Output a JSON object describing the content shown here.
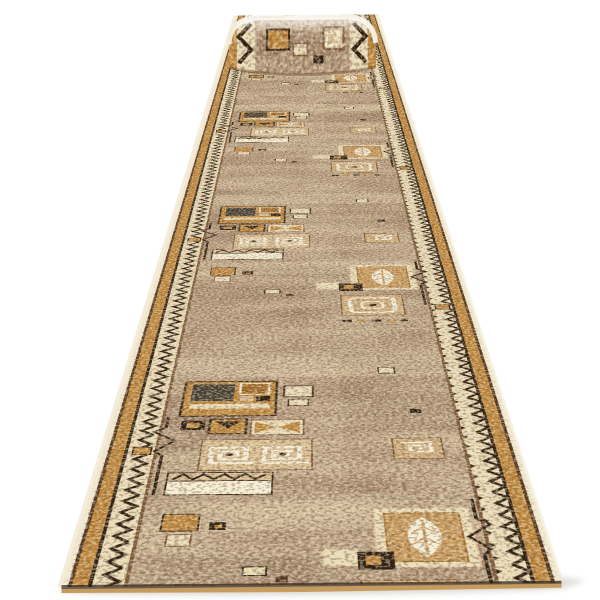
{
  "meta": {
    "alt": "Beige and brown runner carpet with geometric patchwork pattern, far end rolled over, photographed in perspective on a white background"
  },
  "palette": {
    "bg": "#ffffff",
    "creamEdge": "#f2e9d2",
    "cream": "#eadbb7",
    "creamLight": "#f6eed6",
    "tan": "#d9bd93",
    "tanMid": "#cfae7e",
    "caramel": "#c18a41",
    "caramelDeep": "#a26d2b",
    "brown": "#7c5a3a",
    "brownDark": "#55371d",
    "espresso": "#2f2012",
    "field": "#b69b7f",
    "fieldDark": "#8b6e55",
    "fieldLight": "#e2cfac",
    "olive": "#474034",
    "leaf": "#c89a5e",
    "binding": "#c59b5e",
    "shadow": "#c6c2b8"
  },
  "geometry": {
    "plane_left": 59,
    "plane_bottom": 15,
    "plane_w": 500,
    "plane_h": 4070,
    "perspective_px": 1371,
    "tilt_deg": 60,
    "group_rotate_deg": -0.5,
    "roll_left": 229,
    "roll_top": 9,
    "roll_w": 151,
    "roll_h": 67
  },
  "motifs": [
    "zigzag-border",
    "greek-spiral",
    "leaf-panel",
    "chevron-panel",
    "triangle-bowtie",
    "nested-squares",
    "stepped-line",
    "patch-squares"
  ]
}
